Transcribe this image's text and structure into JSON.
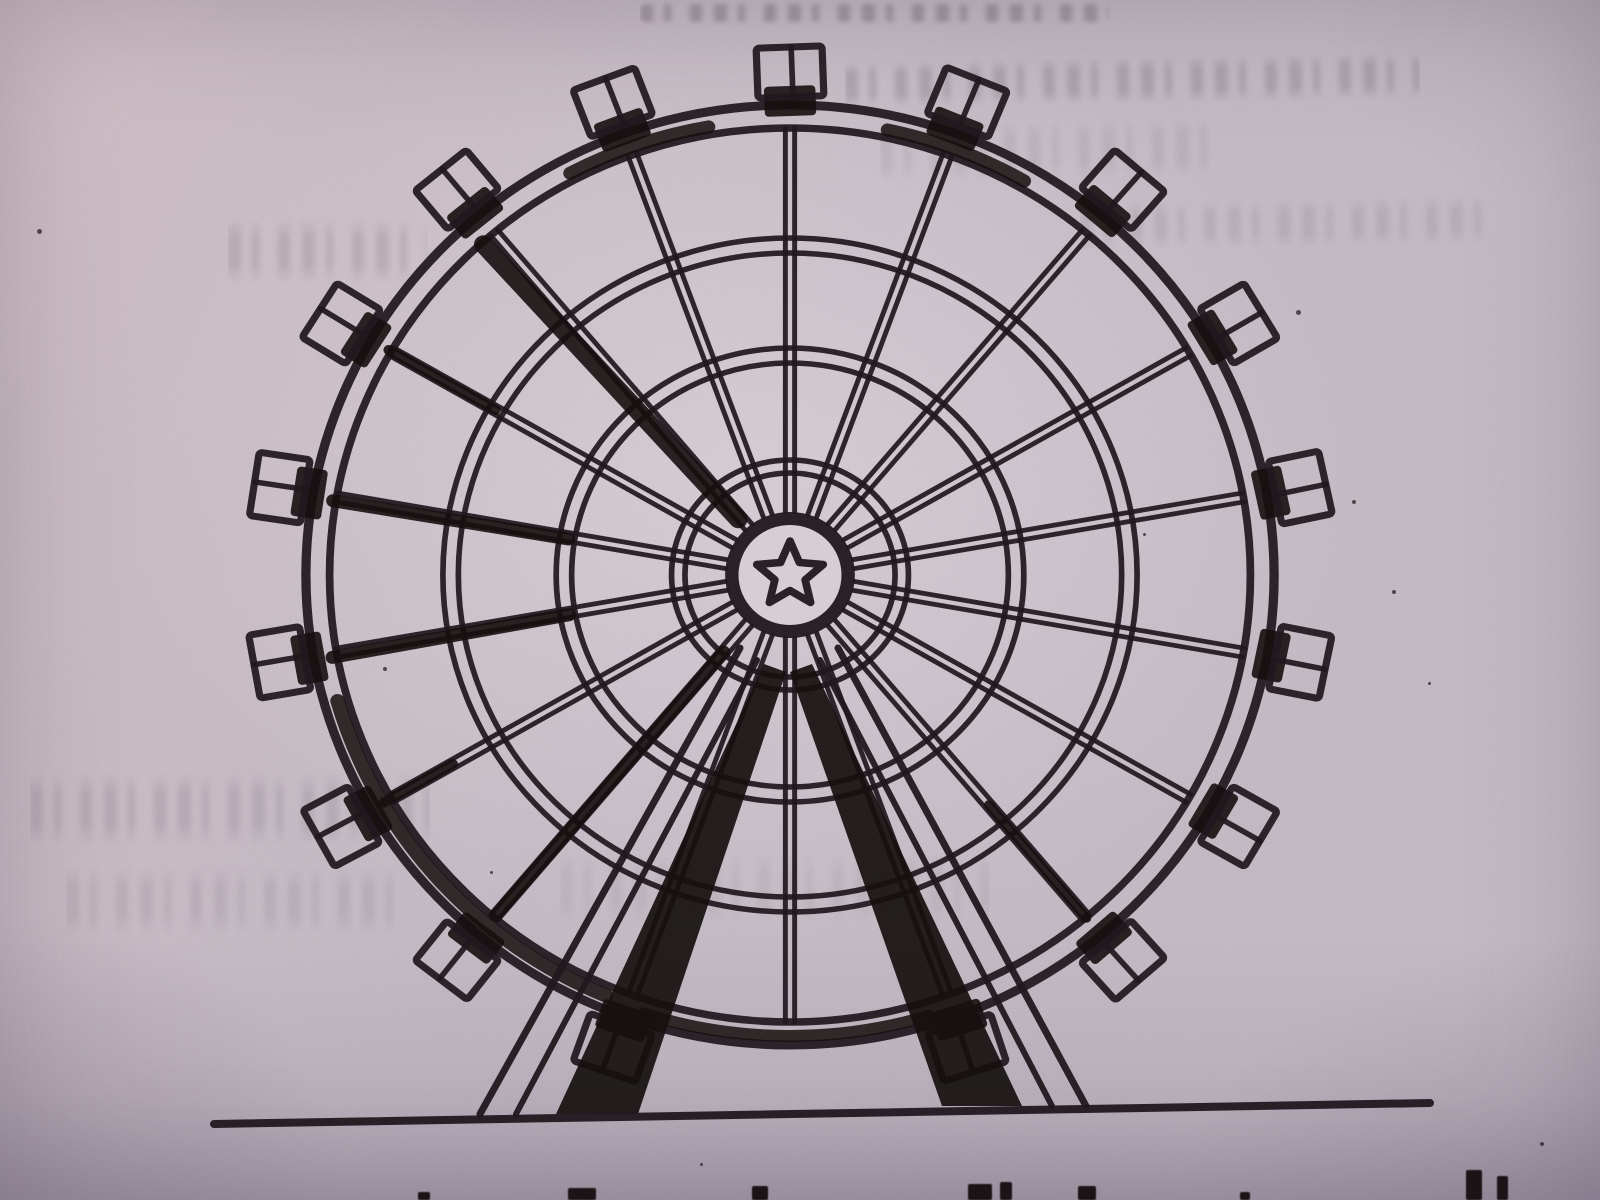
{
  "scene": {
    "kind": "photographed book page",
    "subject": "black ink line drawing of a ferris wheel standing on a ground line",
    "caption_state": "caption text below illustration is cut off at the bottom edge; only letter tops visible",
    "reverse_side_bleed": "faint mirrored text bleed-through visible in paper"
  },
  "colors": {
    "paper_base": "#cdc4ce",
    "paper_light": "#e2dae0",
    "paper_pink_tint": "#e8cdd2",
    "paper_shadow": "#a79dab",
    "ink": "#221920",
    "ink_heavy": "#17100f",
    "bleed_gray": "#5d5260"
  },
  "drawing": {
    "center": {
      "x": 790,
      "y": 575
    },
    "h_stretch": 1.03,
    "rim": {
      "outer_r": 470,
      "outer_w": 9,
      "inner_r": 447,
      "inner_w": 7.5
    },
    "ring_pairs": [
      [
        102,
        115
      ],
      [
        212,
        227
      ],
      [
        322,
        337
      ]
    ],
    "ring_w": 5.5,
    "spokes": {
      "count": 18,
      "start_angle_deg": 90,
      "step_deg": 20,
      "r1": 63,
      "r2": 447,
      "half_gap": 4.5,
      "line_w": 4.8
    },
    "hub": {
      "outer_r": 63,
      "white_r": 50,
      "ring_w": 13,
      "star_points": 5,
      "star_outer_r": 34,
      "star_inner_r": 15.5,
      "star_stroke_w": 7.5
    },
    "cabins": {
      "anchor_r": 503,
      "width": 64,
      "height": 50,
      "box_stroke_w": 7,
      "divider_w": 5.5,
      "skip_angles": [
        270
      ],
      "blob": {
        "x": -26,
        "y": 14,
        "w": 50,
        "h": 30
      }
    },
    "shadow_spokes": [
      {
        "angle": 132,
        "r1": 75,
        "r2": 445,
        "w": 18
      },
      {
        "angle": 150,
        "r1": 330,
        "r2": 450,
        "w": 10
      },
      {
        "angle": 170.5,
        "r1": 218,
        "r2": 450,
        "w": 13
      },
      {
        "angle": 190.5,
        "r1": 218,
        "r2": 452,
        "w": 13
      },
      {
        "angle": 210,
        "r1": 378,
        "r2": 455,
        "w": 10
      },
      {
        "angle": 230,
        "r1": 100,
        "r2": 445,
        "w": 12
      },
      {
        "angle": 310,
        "r1": 300,
        "r2": 448,
        "w": 9
      }
    ],
    "rim_accent_arcs": [
      {
        "a1": 60,
        "a2": 78,
        "r": 455,
        "w": 13
      },
      {
        "a1": 100,
        "a2": 118,
        "r": 455,
        "w": 13
      },
      {
        "a1": 196,
        "a2": 247,
        "r": 457,
        "w": 14
      },
      {
        "a1": 252,
        "a2": 287,
        "r": 461,
        "w": 12
      }
    ],
    "legs": {
      "left": {
        "lineA": [
          740,
          648,
          480,
          1114
        ],
        "lineB": [
          757,
          660,
          516,
          1114
        ],
        "shadow": [
          [
            764,
            664
          ],
          [
            786,
            672
          ],
          [
            638,
            1114
          ],
          [
            556,
            1114
          ]
        ]
      },
      "right": {
        "lineA": [
          838,
          648,
          1086,
          1106
        ],
        "lineB": [
          820,
          660,
          1052,
          1106
        ],
        "shadow": [
          [
            812,
            664
          ],
          [
            790,
            672
          ],
          [
            942,
            1106
          ],
          [
            1022,
            1106
          ]
        ]
      },
      "line_w_outer": 7,
      "line_w_inner": 6
    },
    "ground": {
      "x1": 214,
      "y1": 1124,
      "x2": 1430,
      "y2": 1103,
      "w": 8
    }
  },
  "bleed_smudges": [
    {
      "x": 640,
      "y": 0,
      "w": 470,
      "h": 26,
      "opacity": 0.34,
      "rot": 0
    },
    {
      "x": 845,
      "y": 56,
      "w": 575,
      "h": 48,
      "opacity": 0.22,
      "rot": -1
    },
    {
      "x": 1080,
      "y": 198,
      "w": 420,
      "h": 50,
      "opacity": 0.12,
      "rot": -1
    },
    {
      "x": 228,
      "y": 218,
      "w": 200,
      "h": 66,
      "opacity": 0.16,
      "rot": 0
    },
    {
      "x": 880,
      "y": 120,
      "w": 330,
      "h": 60,
      "opacity": 0.1,
      "rot": -1
    },
    {
      "x": 30,
      "y": 772,
      "w": 400,
      "h": 74,
      "opacity": 0.15,
      "rot": 0
    },
    {
      "x": 66,
      "y": 866,
      "w": 330,
      "h": 70,
      "opacity": 0.11,
      "rot": 0
    },
    {
      "x": 560,
      "y": 852,
      "w": 430,
      "h": 72,
      "opacity": 0.08,
      "rot": 0
    }
  ],
  "caption_letter_tops": [
    {
      "x": 568,
      "y": 1188,
      "w": 28,
      "h": 12
    },
    {
      "x": 752,
      "y": 1186,
      "w": 16,
      "h": 14
    },
    {
      "x": 968,
      "y": 1184,
      "w": 24,
      "h": 16
    },
    {
      "x": 1000,
      "y": 1182,
      "w": 12,
      "h": 18
    },
    {
      "x": 1078,
      "y": 1186,
      "w": 18,
      "h": 14
    },
    {
      "x": 1466,
      "y": 1170,
      "w": 16,
      "h": 30
    },
    {
      "x": 1497,
      "y": 1176,
      "w": 11,
      "h": 24
    },
    {
      "x": 418,
      "y": 1192,
      "w": 12,
      "h": 8
    },
    {
      "x": 1240,
      "y": 1192,
      "w": 10,
      "h": 8
    }
  ],
  "paper_specks": [
    {
      "x": 1296,
      "y": 310,
      "s": 5
    },
    {
      "x": 1352,
      "y": 500,
      "s": 4
    },
    {
      "x": 1392,
      "y": 590,
      "s": 4
    },
    {
      "x": 1428,
      "y": 682,
      "s": 3
    },
    {
      "x": 383,
      "y": 667,
      "s": 4
    },
    {
      "x": 37,
      "y": 229,
      "s": 5
    },
    {
      "x": 490,
      "y": 871,
      "s": 3
    },
    {
      "x": 700,
      "y": 1163,
      "s": 3
    },
    {
      "x": 1143,
      "y": 533,
      "s": 3
    },
    {
      "x": 1540,
      "y": 1142,
      "s": 4
    }
  ]
}
